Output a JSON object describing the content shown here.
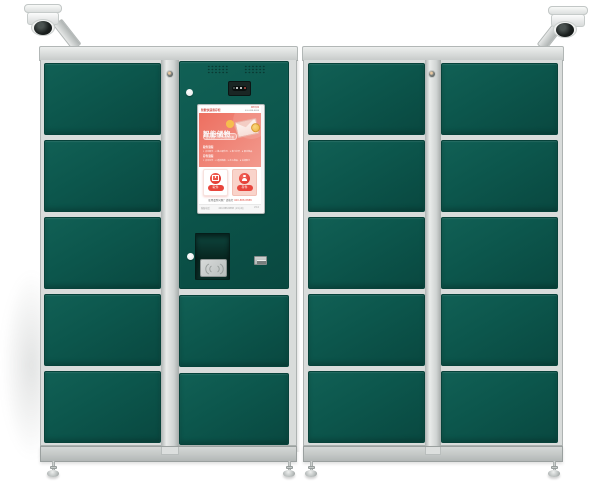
{
  "scene": {
    "subject": "smart parcel locker cabinets with surveillance cameras",
    "background": "#ffffff"
  },
  "colors": {
    "door_green": "#0c564c",
    "door_green_dark": "#094840",
    "frame_grey": "#d9dcdb",
    "strip_grey": "#cfd3d2",
    "base_grey": "#c3c7c6",
    "screen_red_gradient_start": "#ed6f60",
    "screen_red_gradient_end": "#f29a8e",
    "accent_red": "#e8453c",
    "accent_yellow": "#f6c14b",
    "camera_white": "#f1f2f1",
    "dome_black": "#151918"
  },
  "structure": {
    "left_cabinet": {
      "door_rows": 5,
      "control_column_doors": 2
    },
    "right_cabinet": {
      "door_rows": 5,
      "door_columns": 2
    },
    "cameras": 2,
    "leveling_feet": 4
  },
  "screen": {
    "header_left": "智能快递寄存柜",
    "header_right_line1": "服务热线",
    "header_right_line2": "400-888-8888",
    "title": "智能储物",
    "tag": "安全便捷 · 24小时自助存取",
    "section1_label": "取件流程",
    "section1_steps": "1 点击取件 · 2 输入取件码 · 3 柜门打开 · 4 取走物品",
    "section2_label": "存件流程",
    "section2_steps": "1 点击存件 · 2 选择箱格 · 3 存入物品 · 4 关闭柜门",
    "pickup_button": "取件",
    "deposit_button": "存件",
    "notice_text": "使用遇到问题？请拨打",
    "notice_phone": "400-888-8888",
    "footer_left": "客服电话",
    "footer_center": "400-888-8888（24小时）",
    "footer_right": "V2.0"
  }
}
